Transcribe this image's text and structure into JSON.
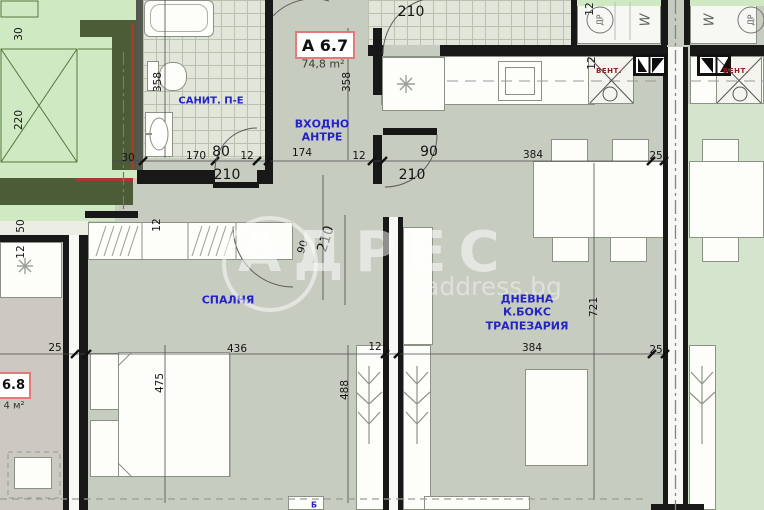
{
  "apartment": {
    "label": "A 6.7",
    "area": "74,8 m²"
  },
  "neighbor": {
    "label": "6.8",
    "area": "4 м²"
  },
  "rooms": {
    "bathroom": "САНИТ. П-Е",
    "hall_line1": "ВХОДНО",
    "hall_line2": "АНТРЕ",
    "bedroom": "СПАЛНЯ",
    "living_line1": "ДНЕВНА",
    "living_line2": "К.БОКС",
    "living_line3": "ТРАПЕЗАРИЯ"
  },
  "vent_label": "ВЕНТ.",
  "appliance_symbols": {
    "circle_left": "ДР",
    "w_left": "W",
    "w_right": "W",
    "circle_right": "ДР"
  },
  "bottom_fragment": "Б",
  "watermark": {
    "brand": "АДРЕС",
    "domain": "address.bg"
  },
  "dims": [
    "30",
    "220",
    "50",
    "12",
    "358",
    "358",
    "30",
    "170",
    "80",
    "12",
    "210",
    "174",
    "12",
    "90",
    "210",
    "210",
    "12",
    "12",
    "384",
    "25",
    "12",
    "90",
    "210",
    "25",
    "436",
    "475",
    "12",
    "488",
    "384",
    "25",
    "721"
  ],
  "colors": {
    "main_floor": "#c7ccc0",
    "terrace_green": "#cfe9c3",
    "neighbor_right_floor": "#d5e4cc",
    "neighbor_left_floor": "#ccc8c2",
    "tile": "#e2e5d9",
    "wall": "#181818",
    "garden_wall": "#4c5c36",
    "red_line": "#b13434",
    "label_blue": "#2323c6",
    "vent_red": "#8b2020",
    "apartment_box_border": "#e87878"
  }
}
